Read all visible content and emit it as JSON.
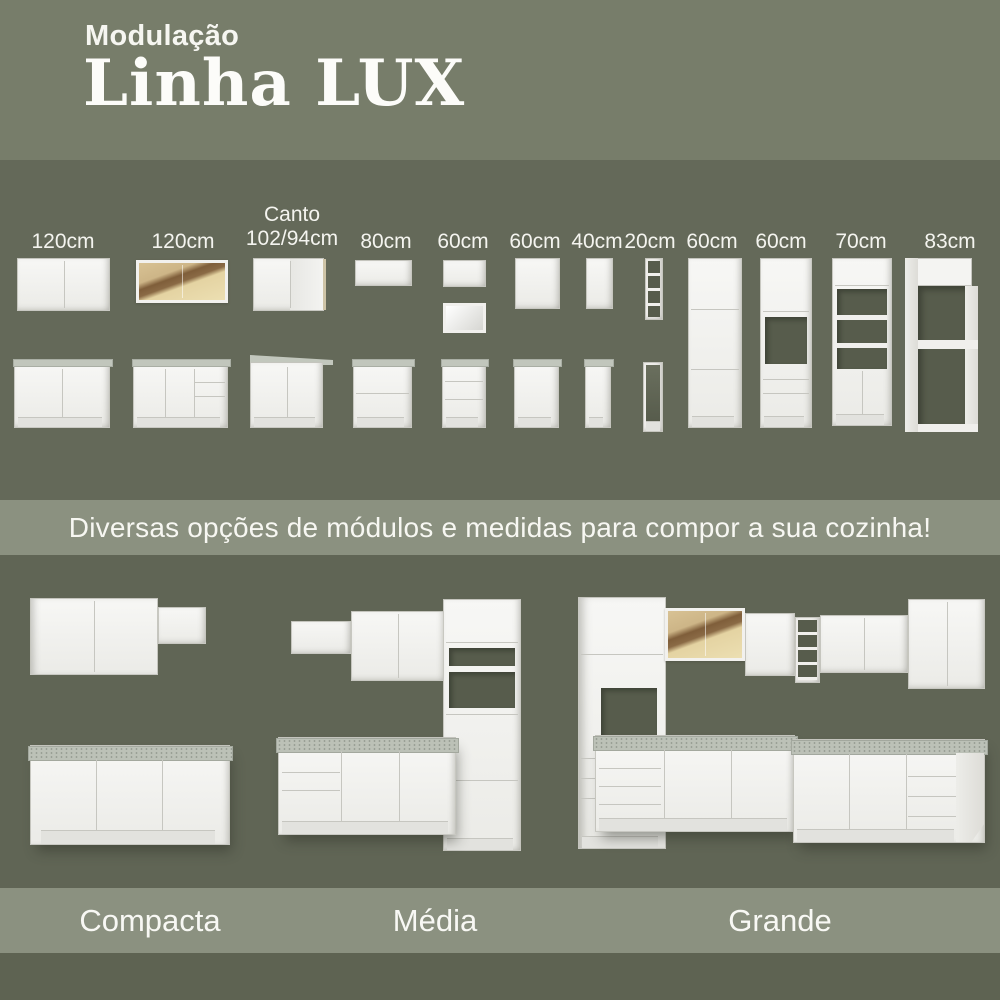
{
  "header": {
    "eyebrow": "Modulação",
    "title": "Linha LUX"
  },
  "modules": {
    "items": [
      {
        "label": "120cm",
        "description": "2-door wall cabinet + 2-door base cabinet with countertop"
      },
      {
        "label": "120cm",
        "description": "amber glass-door wall cabinet + base cabinet with doors and drawers"
      },
      {
        "label": "Canto\n102/94cm",
        "description": "corner wall cabinet + corner base cabinet with angled countertop"
      },
      {
        "label": "80cm",
        "description": "flip-up wall cabinet + 2-drawer base cabinet"
      },
      {
        "label": "60cm",
        "description": "flip-up wall cabinet with open niche + 3-drawer base cabinet"
      },
      {
        "label": "60cm",
        "description": "1-door wall cabinet + 1-door base cabinet"
      },
      {
        "label": "40cm",
        "description": "narrow 1-door wall cabinet + narrow base cabinet"
      },
      {
        "label": "20cm",
        "description": "narrow open-shelf wall unit + open base unit"
      },
      {
        "label": "60cm",
        "description": "tall 3-door pantry cabinet"
      },
      {
        "label": "60cm",
        "description": "tall oven tower with niche and drawers"
      },
      {
        "label": "70cm",
        "description": "tall cabinet with open shelves and double doors"
      },
      {
        "label": "83cm",
        "description": "tall open refrigerator surround frame"
      }
    ]
  },
  "tagline": {
    "text": "Diversas opções de módulos e medidas para compor a sua cozinha!"
  },
  "layouts": {
    "items": [
      {
        "label": "Compacta",
        "description": "compact straight kitchen"
      },
      {
        "label": "Média",
        "description": "medium straight kitchen with tall tower"
      },
      {
        "label": "Grande",
        "description": "large L-shaped kitchen with glass cabinet and towers"
      }
    ]
  },
  "colors": {
    "header_bg": "#777d6a",
    "modules_bg": "#646959",
    "band_bg": "#8b9180",
    "kitchens_bg": "#606555",
    "footer_bg": "#5e6352",
    "text": "#f6f6f1",
    "cabinet_white": "#f2f2ef",
    "countertop_gray": "#bcc1b7",
    "niche_dark": "#575c4c",
    "glass_light": "#e6d5a5",
    "glass_brown": "#80603c"
  }
}
